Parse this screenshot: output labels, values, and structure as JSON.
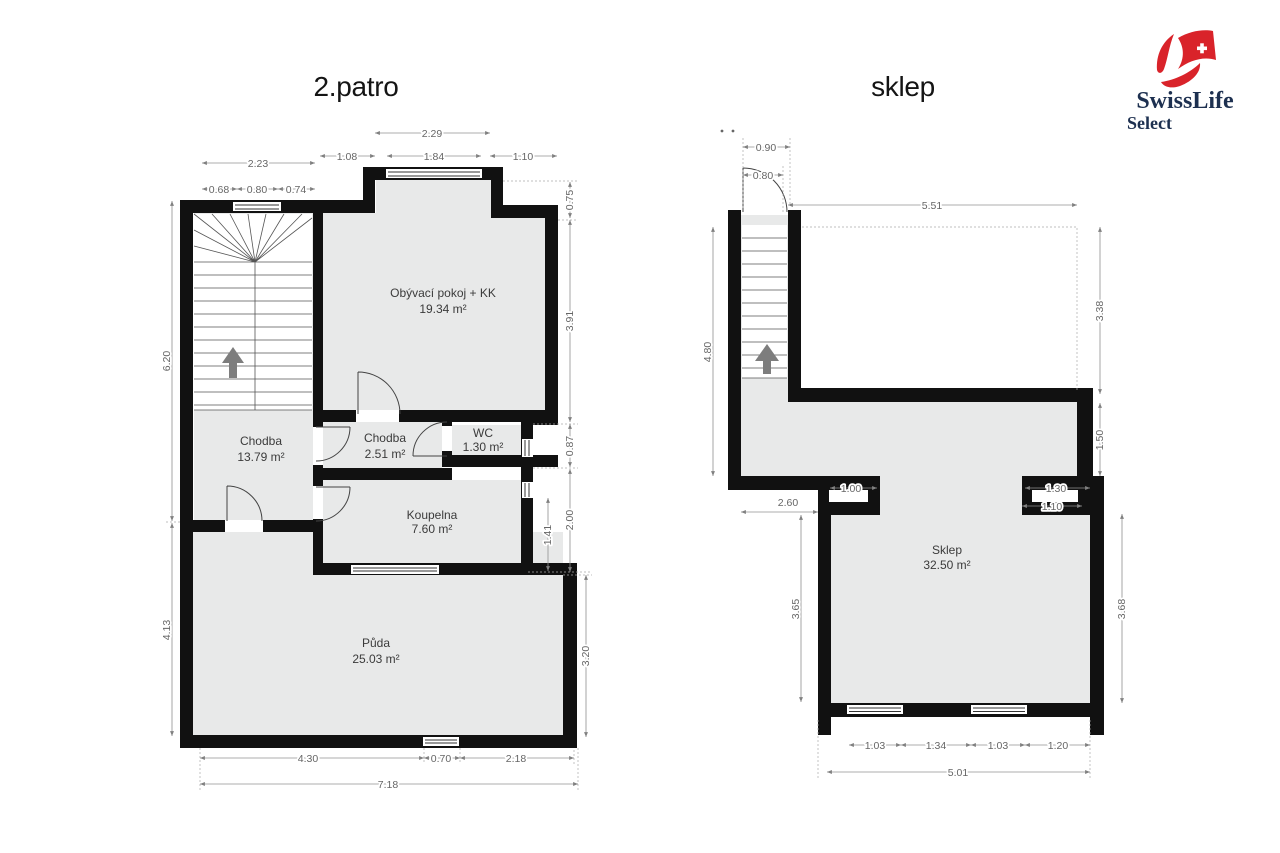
{
  "colors": {
    "wall": "#111111",
    "room_fill": "#e8e9e9",
    "dim_text": "#666666",
    "logo_red": "#d9232a",
    "logo_navy": "#1d3050"
  },
  "logo": {
    "brand": "SwissLife",
    "sub": "Select"
  },
  "plan_left": {
    "title": "2.patro",
    "rooms": [
      {
        "name": "Obývací pokoj + KK",
        "area": "19.34 m²"
      },
      {
        "name": "Chodba",
        "area": "13.79 m²"
      },
      {
        "name": "Chodba",
        "area": "2.51 m²"
      },
      {
        "name": "WC",
        "area": "1.30 m²"
      },
      {
        "name": "Koupelna",
        "area": "7.60 m²"
      },
      {
        "name": "Půda",
        "area": "25.03 m²"
      }
    ],
    "dims": {
      "top": [
        "2.29",
        "1.08",
        "1.84",
        "1.10",
        "2.23",
        "0.68",
        "0.80",
        "0.74"
      ],
      "right": [
        "0.75",
        "3.91",
        "0.87",
        "2.00",
        "1.41",
        "3.20"
      ],
      "left": [
        "6.20",
        "4.13"
      ],
      "bottom": [
        "4.30",
        "0.70",
        "2.18",
        "7.18"
      ]
    }
  },
  "plan_right": {
    "title": "sklep",
    "rooms": [
      {
        "name": "Sklep",
        "area": "32.50 m²"
      }
    ],
    "dims": {
      "top": [
        "0.90",
        "0.80",
        "5.51"
      ],
      "right": [
        "3.38",
        "1.50",
        "1.30",
        "1.10",
        "3.68"
      ],
      "left": [
        "4.80",
        "2.60",
        "1.00",
        "3.65"
      ],
      "bottom": [
        "1.03",
        "1.34",
        "1.03",
        "1.20",
        "5.01"
      ]
    }
  }
}
